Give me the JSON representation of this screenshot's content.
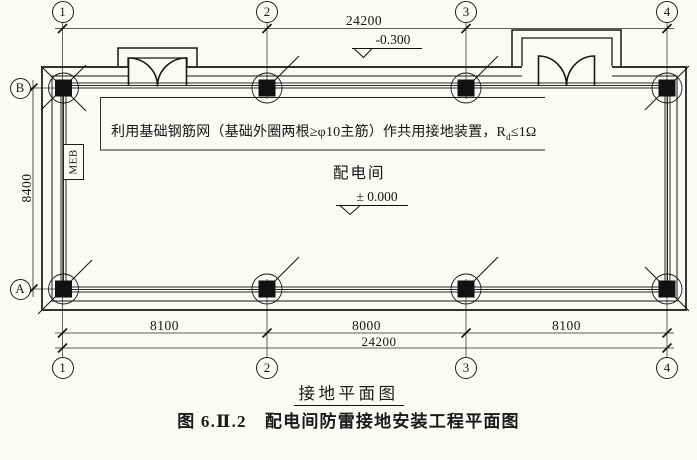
{
  "drawing": {
    "grid_top": [
      "1",
      "2",
      "3",
      "4"
    ],
    "grid_bottom": [
      "1",
      "2",
      "3",
      "4"
    ],
    "rows": {
      "b": "B",
      "a": "A"
    },
    "dims": {
      "top_overall": "24200",
      "left_height": "8400",
      "bottom_segments": [
        "8100",
        "8000",
        "8100"
      ],
      "bottom_overall": "24200"
    },
    "elevations": {
      "outdoor": "-0.300",
      "indoor": "± 0.000"
    },
    "labels": {
      "room": "配电间",
      "meb": "MEB"
    },
    "note": {
      "main": "利用基础钢筋网（基础外圈两根≥φ10主筋）作共用接地装置，R",
      "sub": "d",
      "tail": "≤1Ω"
    },
    "captions": {
      "subtitle": "接地平面图",
      "figure_title": "图 6.Ⅱ.2　配电间防雷接地安装工程平面图"
    },
    "colors": {
      "line": "#1a1a1a",
      "paper": "#fbfaf6",
      "column_fill": "#111111"
    }
  }
}
